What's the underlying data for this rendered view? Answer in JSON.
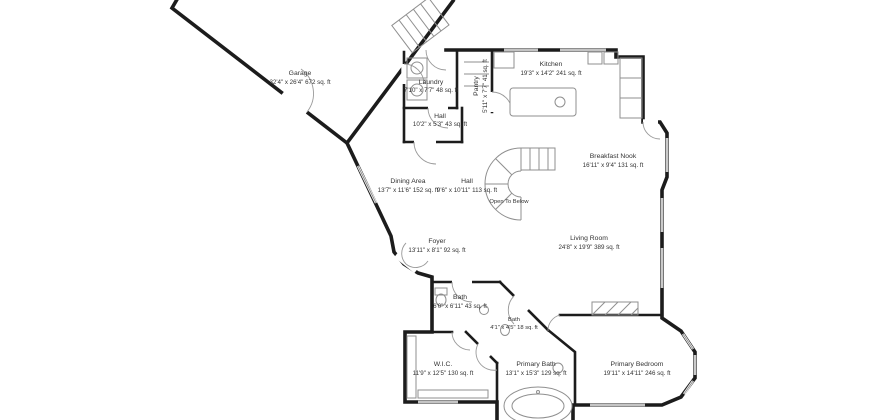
{
  "plan": {
    "background": "#ffffff",
    "wall_color": "#1c1c1c",
    "fixture_color": "#8f8f8f",
    "text_color": "#333333"
  },
  "rooms": [
    {
      "name": "Garage",
      "dims": "32'4\" x 26'4\" 672 sq. ft"
    },
    {
      "name": "Laundry",
      "dims": "7'10\" x 7'7\" 48 sq. ft"
    },
    {
      "name": "Pantry",
      "dims": "5'11\" x 7'7\" 41 sq. ft"
    },
    {
      "name": "Kitchen",
      "dims": "19'3\" x 14'2\" 241 sq. ft"
    },
    {
      "name": "Hall",
      "dims": "10'2\" x 5'3\" 43 sq. ft"
    },
    {
      "name": "Breakfast Nook",
      "dims": "16'11\" x 9'4\" 131 sq. ft"
    },
    {
      "name": "Dining Area",
      "dims": "13'7\" x 11'6\" 152 sq. ft"
    },
    {
      "name": "Hall",
      "dims": "9'6\" x 10'11\" 113 sq. ft"
    },
    {
      "name": "Open To Below",
      "dims": ""
    },
    {
      "name": "Living Room",
      "dims": "24'8\" x 19'9\" 389 sq. ft"
    },
    {
      "name": "Foyer",
      "dims": "13'11\" x 8'1\" 92 sq. ft"
    },
    {
      "name": "Bath",
      "dims": "6'0\" x 6'11\" 43 sq. ft"
    },
    {
      "name": "Bath",
      "dims": "4'1\" x 4'5\" 18 sq. ft"
    },
    {
      "name": "W.I.C.",
      "dims": "11'9\" x 12'5\" 130 sq. ft"
    },
    {
      "name": "Primary Bath",
      "dims": "13'1\" x 15'3\" 129 sq. ft"
    },
    {
      "name": "Primary Bedroom",
      "dims": "19'11\" x 14'11\" 246 sq. ft"
    }
  ]
}
